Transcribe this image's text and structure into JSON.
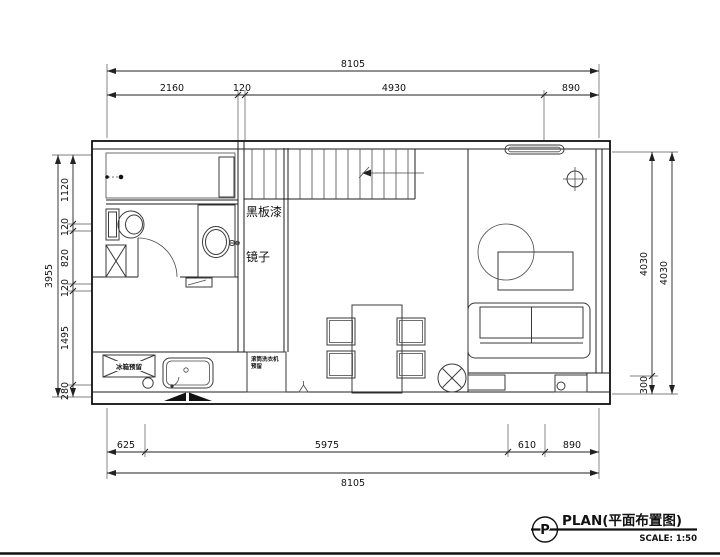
{
  "callout": {
    "letter": "P",
    "title": "PLAN(平面布置图)",
    "scale": "SCALE: 1:50"
  },
  "labels": {
    "blackboard_paint": "黑板漆",
    "mirror": "镜子",
    "fridge": "冰箱预留",
    "washer_line1": "滚筒洗衣机",
    "washer_line2": "预留"
  },
  "dims": {
    "top_total": "8105",
    "top_segments": [
      "2160",
      "120",
      "4930",
      "890"
    ],
    "left_total": "3955",
    "left_segments": [
      "1120",
      "120",
      "820",
      "120",
      "1495",
      "280"
    ],
    "right_inner_segments": [
      "4030",
      "300"
    ],
    "right_outer_total": "4030",
    "bottom_segments": [
      "625",
      "5975",
      "610",
      "890"
    ],
    "bottom_total": "8105"
  }
}
